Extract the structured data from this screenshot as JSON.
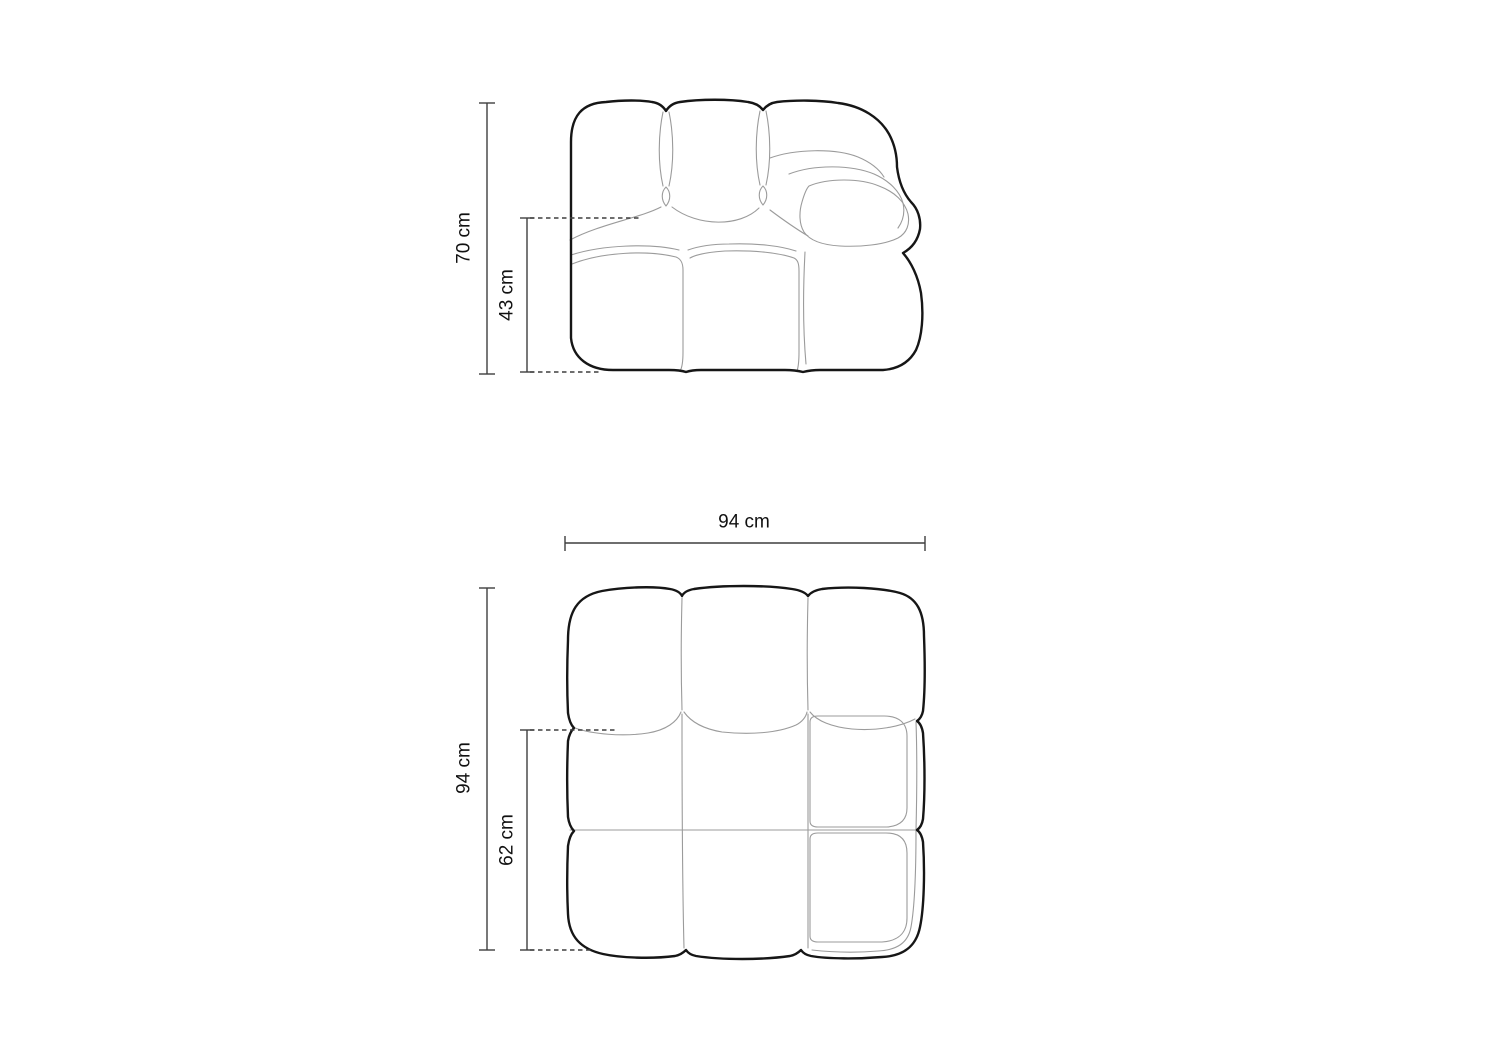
{
  "diagram": {
    "front_view": {
      "overall_height": "70 cm",
      "seat_height": "43 cm"
    },
    "top_view": {
      "overall_width": "94 cm",
      "overall_depth": "94 cm",
      "seat_depth": "62 cm"
    }
  },
  "colors": {
    "background": "#ffffff",
    "outline": "#161616",
    "inner_line": "#9b9b9b",
    "dimension_line": "#3f3f3f",
    "label_text": "#111111"
  }
}
